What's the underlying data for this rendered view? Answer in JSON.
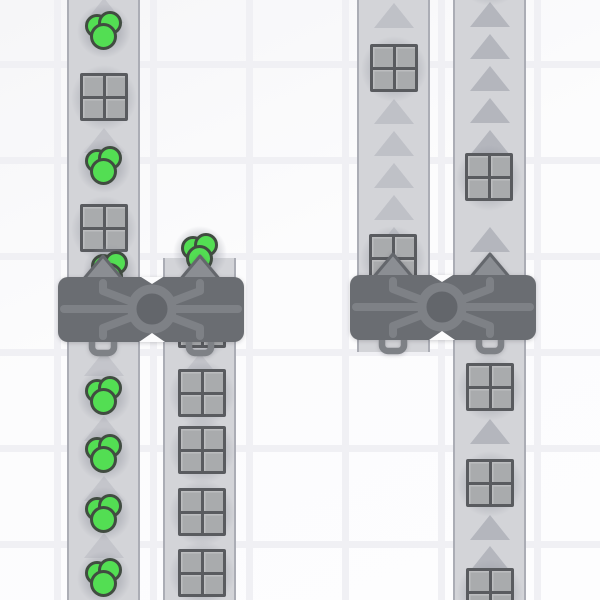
{
  "scene": {
    "width": 600,
    "height": 600,
    "background": {
      "tile_color": "#fcfcfd",
      "grout_color": "#f0f0f4",
      "grout_width": 7,
      "vertical_lines": [
        57,
        153,
        249,
        345,
        441,
        537
      ],
      "horizontal_lines": [
        64,
        160,
        256,
        352,
        448,
        544
      ]
    },
    "belt_style": {
      "width": 73,
      "fill": "#d3d4d8",
      "edge_color": "#abadb5",
      "edge_width": 2,
      "arrow_color": "#b2b4bc",
      "arrow_width": 40,
      "arrow_height": 25,
      "direction": "up"
    },
    "belts": [
      {
        "id": "belt-left-a",
        "x": 67,
        "top": 0,
        "bottom": 600,
        "direction": "up",
        "arrow_opacity": 0.45,
        "arrows_y": [
          10,
          140,
          363,
          428,
          488,
          545
        ]
      },
      {
        "id": "belt-left-b",
        "x": 163,
        "top": 258,
        "bottom": 600,
        "direction": "up",
        "arrow_opacity": 0.45,
        "arrows_y": [
          365
        ]
      },
      {
        "id": "belt-right-c",
        "x": 357,
        "top": 0,
        "bottom": 352,
        "direction": "up",
        "arrow_opacity": 0.6,
        "arrows_y": [
          15,
          111,
          143,
          175,
          207,
          239
        ]
      },
      {
        "id": "belt-right-d",
        "x": 453,
        "top": 0,
        "bottom": 600,
        "direction": "up",
        "arrow_opacity": 0.95,
        "arrows_y": [
          14,
          46,
          78,
          110,
          142,
          239,
          431,
          527,
          558
        ]
      }
    ],
    "item_styles": {
      "shadow_color_inner": "rgba(145,148,158,0.45)",
      "shadow_color_outer": "rgba(145,148,158,0)",
      "square": {
        "size": 48,
        "frame_color": "#595b5f",
        "cell_color": "#a9abad",
        "shadow_diameter": 66
      },
      "circles": {
        "size": 40,
        "fill": "#53de53",
        "outline": "#414c41",
        "circle_diameter": 24,
        "front_circle_diameter": 27,
        "shadow_diameter": 54
      }
    },
    "items": [
      {
        "type": "circles",
        "x": 104,
        "y": 30
      },
      {
        "type": "square",
        "x": 104,
        "y": 97
      },
      {
        "type": "circles",
        "x": 104,
        "y": 165
      },
      {
        "type": "square",
        "x": 104,
        "y": 228
      },
      {
        "type": "circles",
        "x": 110,
        "y": 270
      },
      {
        "type": "circles",
        "x": 200,
        "y": 252
      },
      {
        "type": "circles",
        "x": 104,
        "y": 395
      },
      {
        "type": "circles",
        "x": 104,
        "y": 453
      },
      {
        "type": "circles",
        "x": 104,
        "y": 513
      },
      {
        "type": "circles",
        "x": 104,
        "y": 577
      },
      {
        "type": "square",
        "x": 202,
        "y": 324
      },
      {
        "type": "square",
        "x": 202,
        "y": 393
      },
      {
        "type": "square",
        "x": 202,
        "y": 450
      },
      {
        "type": "square",
        "x": 202,
        "y": 512
      },
      {
        "type": "square",
        "x": 202,
        "y": 573
      },
      {
        "type": "square",
        "x": 394,
        "y": 68
      },
      {
        "type": "square",
        "x": 393,
        "y": 258
      },
      {
        "type": "square",
        "x": 490,
        "y": -28
      },
      {
        "type": "square",
        "x": 489,
        "y": 177
      },
      {
        "type": "square",
        "x": 490,
        "y": 387
      },
      {
        "type": "square",
        "x": 490,
        "y": 483
      },
      {
        "type": "square",
        "x": 490,
        "y": 592
      }
    ],
    "machine_style": {
      "body_color": "#6a6d72",
      "pipe_color": "#7e8186",
      "ring_hole_color": "#63666b",
      "arrow_fill": "#8b8e93",
      "arrow_outline": "#64676c",
      "notch_color": "#fcfcfd",
      "body_width": 186,
      "body_height": 65
    },
    "machines": [
      {
        "id": "balancer-left",
        "x": 58,
        "y": 277,
        "outputs_x": [
          45,
          142
        ]
      },
      {
        "id": "balancer-right",
        "x": 350,
        "y": 275,
        "outputs_x": [
          43,
          140
        ]
      }
    ]
  }
}
